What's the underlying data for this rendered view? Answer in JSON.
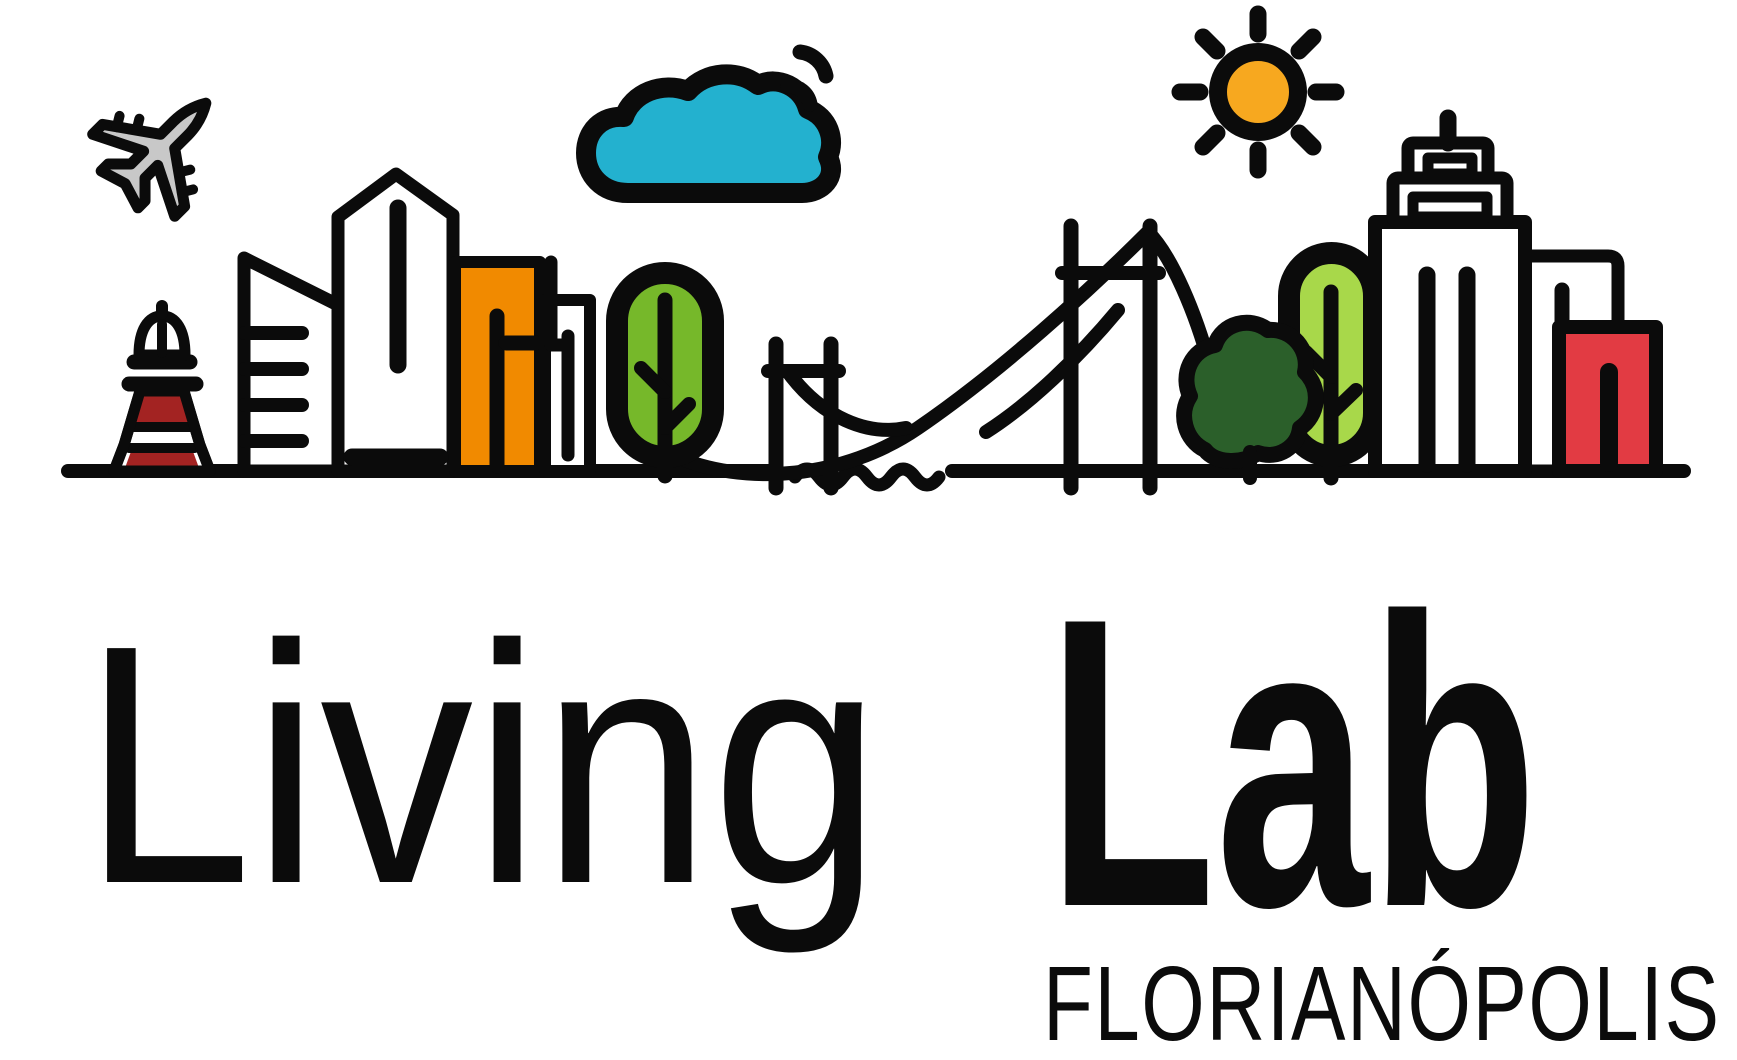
{
  "logo": {
    "brand_line1": "Living",
    "brand_line2": "Lab",
    "city": "FLORIANÓPOLIS"
  },
  "colors": {
    "ink": "#0b0b0b",
    "white": "#ffffff",
    "cloud_teal": "#23b1cf",
    "sun_orange": "#f7a81f",
    "building_orange": "#f18a00",
    "tree_green": "#76b82a",
    "tree_light_green": "#a8d84a",
    "tree_dark_green": "#2b5f2a",
    "lighthouse_red": "#a32322",
    "building_red": "#e23b43",
    "plane_gray": "#c8c8c8"
  },
  "icons": [
    "airplane-icon",
    "lighthouse-icon",
    "cloud-icon",
    "wifi-signal-icon",
    "sun-icon",
    "suspension-bridge-icon",
    "tree-icon",
    "bush-tree-icon",
    "skyline-buildings-icon",
    "water-wave-icon",
    "ground-line"
  ]
}
